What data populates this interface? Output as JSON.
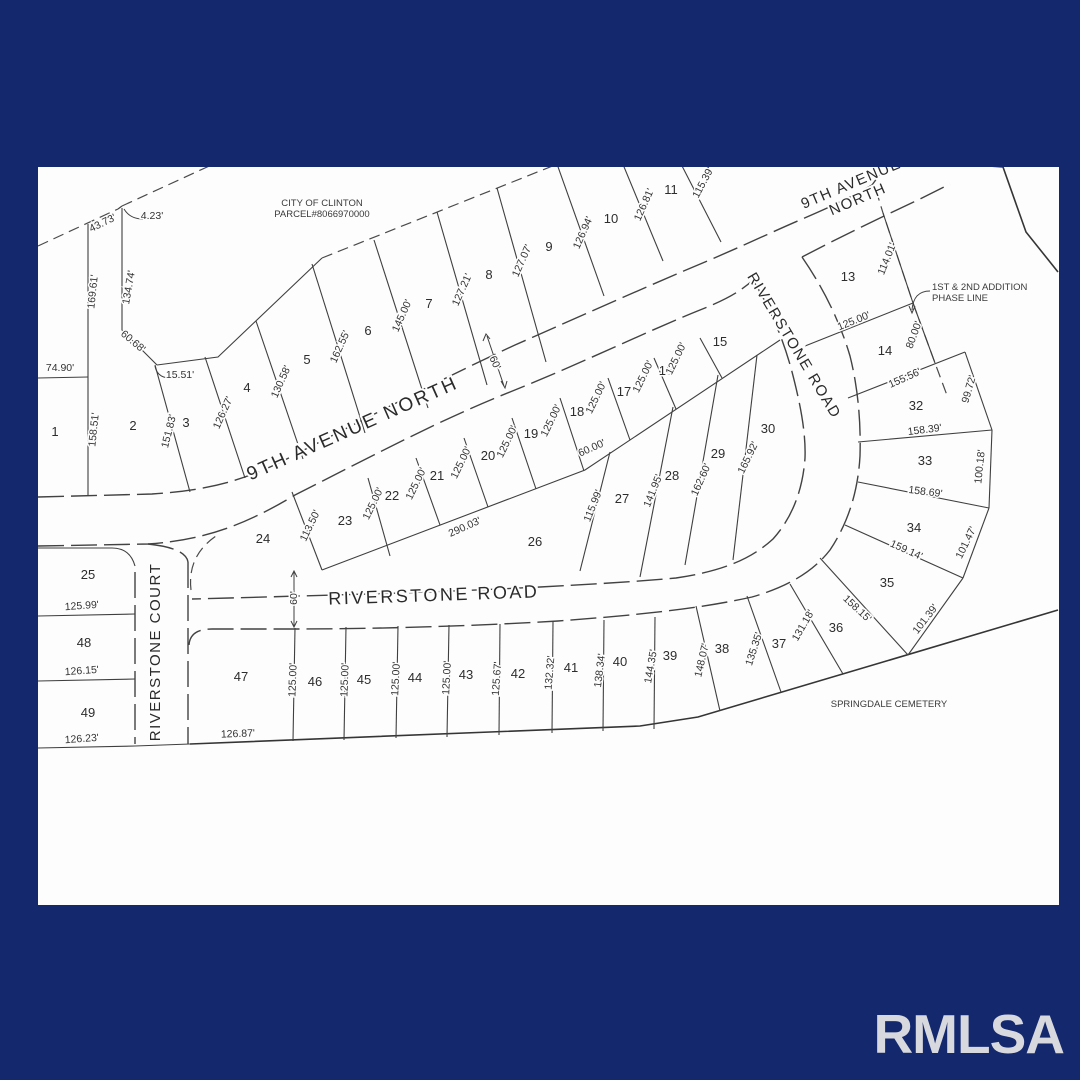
{
  "frame": {
    "navy": "#14286e",
    "paper": "#fdfdfd",
    "watermark": "RMLSA"
  },
  "streets": [
    {
      "name": "street-label-9th-avenue-north-main",
      "lines": [
        "9TH AVENUE NORTH"
      ],
      "x": 355,
      "y": 434,
      "r": -24,
      "size": 19,
      "ls": 2.5
    },
    {
      "name": "street-label-9th-avenue-north-top",
      "lines": [
        "9TH AVENUE",
        "NORTH"
      ],
      "x": 853,
      "y": 188,
      "r": -23,
      "size": 15,
      "ls": 1.5
    },
    {
      "name": "street-label-riverstone-road-upper",
      "lines": [
        "RIVERSTONE ROAD"
      ],
      "x": 790,
      "y": 348,
      "r": 59,
      "size": 15,
      "ls": 1.5
    },
    {
      "name": "street-label-riverstone-road-lower",
      "lines": [
        "RIVERSTONE ROAD"
      ],
      "x": 434,
      "y": 601,
      "r": -2,
      "size": 18,
      "ls": 2.5
    },
    {
      "name": "street-label-riverstone-court",
      "lines": [
        "RIVERSTONE COURT"
      ],
      "x": 160,
      "y": 652,
      "r": -90,
      "size": 15,
      "ls": 1.5
    }
  ],
  "notes": [
    {
      "name": "note-city-parcel",
      "lines": [
        "CITY OF CLINTON",
        "PARCEL#8066970000"
      ],
      "x": 322,
      "y": 206,
      "anchor": "middle"
    },
    {
      "name": "note-phase-line",
      "lines": [
        "1ST & 2ND ADDITION",
        "PHASE LINE"
      ],
      "x": 932,
      "y": 290,
      "anchor": "start"
    },
    {
      "name": "note-springdale-cemetery",
      "lines": [
        "SPRINGDALE CEMETERY"
      ],
      "x": 889,
      "y": 707,
      "anchor": "middle"
    }
  ],
  "lots": [
    {
      "n": "1",
      "x": 55,
      "y": 436
    },
    {
      "n": "2",
      "x": 133,
      "y": 430
    },
    {
      "n": "3",
      "x": 186,
      "y": 427
    },
    {
      "n": "4",
      "x": 247,
      "y": 392
    },
    {
      "n": "5",
      "x": 307,
      "y": 364
    },
    {
      "n": "6",
      "x": 368,
      "y": 335
    },
    {
      "n": "7",
      "x": 429,
      "y": 308
    },
    {
      "n": "8",
      "x": 489,
      "y": 279
    },
    {
      "n": "9",
      "x": 549,
      "y": 251
    },
    {
      "n": "10",
      "x": 611,
      "y": 223
    },
    {
      "n": "11",
      "x": 671,
      "y": 194
    },
    {
      "n": "13",
      "x": 848,
      "y": 281
    },
    {
      "n": "14",
      "x": 885,
      "y": 355
    },
    {
      "n": "15",
      "x": 720,
      "y": 346
    },
    {
      "n": "16",
      "x": 666,
      "y": 375
    },
    {
      "n": "17",
      "x": 624,
      "y": 396
    },
    {
      "n": "18",
      "x": 577,
      "y": 416
    },
    {
      "n": "19",
      "x": 531,
      "y": 438
    },
    {
      "n": "20",
      "x": 488,
      "y": 460
    },
    {
      "n": "21",
      "x": 437,
      "y": 480
    },
    {
      "n": "22",
      "x": 392,
      "y": 500
    },
    {
      "n": "23",
      "x": 345,
      "y": 525
    },
    {
      "n": "24",
      "x": 263,
      "y": 543
    },
    {
      "n": "25",
      "x": 88,
      "y": 579
    },
    {
      "n": "26",
      "x": 535,
      "y": 546
    },
    {
      "n": "27",
      "x": 622,
      "y": 503
    },
    {
      "n": "28",
      "x": 672,
      "y": 480
    },
    {
      "n": "29",
      "x": 718,
      "y": 458
    },
    {
      "n": "30",
      "x": 768,
      "y": 433
    },
    {
      "n": "32",
      "x": 916,
      "y": 410
    },
    {
      "n": "33",
      "x": 925,
      "y": 465
    },
    {
      "n": "34",
      "x": 914,
      "y": 532
    },
    {
      "n": "35",
      "x": 887,
      "y": 587
    },
    {
      "n": "36",
      "x": 836,
      "y": 632
    },
    {
      "n": "37",
      "x": 779,
      "y": 648
    },
    {
      "n": "38",
      "x": 722,
      "y": 653
    },
    {
      "n": "39",
      "x": 670,
      "y": 660
    },
    {
      "n": "40",
      "x": 620,
      "y": 666
    },
    {
      "n": "41",
      "x": 571,
      "y": 672
    },
    {
      "n": "42",
      "x": 518,
      "y": 678
    },
    {
      "n": "43",
      "x": 466,
      "y": 679
    },
    {
      "n": "44",
      "x": 415,
      "y": 682
    },
    {
      "n": "45",
      "x": 364,
      "y": 684
    },
    {
      "n": "46",
      "x": 315,
      "y": 686
    },
    {
      "n": "47",
      "x": 241,
      "y": 681
    },
    {
      "n": "48",
      "x": 84,
      "y": 647
    },
    {
      "n": "49",
      "x": 88,
      "y": 717
    }
  ],
  "dims": [
    {
      "t": "43.73'",
      "x": 104,
      "y": 226,
      "r": -26
    },
    {
      "t": "4.23'",
      "x": 152,
      "y": 219,
      "r": 0
    },
    {
      "t": "134.74'",
      "x": 132,
      "y": 288,
      "r": -80
    },
    {
      "t": "169.61'",
      "x": 96,
      "y": 292,
      "r": -84
    },
    {
      "t": "74.90'",
      "x": 60,
      "y": 371,
      "r": 0
    },
    {
      "t": "60.68'",
      "x": 131,
      "y": 344,
      "r": 40
    },
    {
      "t": "15.51'",
      "x": 180,
      "y": 378,
      "r": 0
    },
    {
      "t": "158.51'",
      "x": 97,
      "y": 430,
      "r": -84
    },
    {
      "t": "151.83'",
      "x": 172,
      "y": 432,
      "r": -76
    },
    {
      "t": "126.27'",
      "x": 226,
      "y": 414,
      "r": -66
    },
    {
      "t": "130.58'",
      "x": 284,
      "y": 383,
      "r": -66
    },
    {
      "t": "162.55'",
      "x": 343,
      "y": 348,
      "r": -66
    },
    {
      "t": "145.00'",
      "x": 405,
      "y": 317,
      "r": -66
    },
    {
      "t": "127.21'",
      "x": 465,
      "y": 291,
      "r": -66
    },
    {
      "t": "127.07'",
      "x": 525,
      "y": 262,
      "r": -66
    },
    {
      "t": "126.94'",
      "x": 586,
      "y": 234,
      "r": -66
    },
    {
      "t": "126.81'",
      "x": 647,
      "y": 206,
      "r": -66
    },
    {
      "t": "115.39'",
      "x": 706,
      "y": 184,
      "r": -62
    },
    {
      "t": "114.01'",
      "x": 890,
      "y": 260,
      "r": -68
    },
    {
      "t": "125.00'",
      "x": 855,
      "y": 324,
      "r": -22
    },
    {
      "t": "80.00'",
      "x": 917,
      "y": 336,
      "r": -70
    },
    {
      "t": "155.56'",
      "x": 906,
      "y": 381,
      "r": -24
    },
    {
      "t": "99.72'",
      "x": 972,
      "y": 390,
      "r": -74
    },
    {
      "t": "158.39'",
      "x": 925,
      "y": 433,
      "r": -7
    },
    {
      "t": "100.18'",
      "x": 983,
      "y": 467,
      "r": -84
    },
    {
      "t": "158.69'",
      "x": 925,
      "y": 495,
      "r": 7
    },
    {
      "t": "101.47'",
      "x": 969,
      "y": 544,
      "r": -64
    },
    {
      "t": "159.14'",
      "x": 905,
      "y": 553,
      "r": 24
    },
    {
      "t": "158.15'",
      "x": 855,
      "y": 611,
      "r": 43
    },
    {
      "t": "101.39'",
      "x": 928,
      "y": 621,
      "r": -52
    },
    {
      "t": "131.18'",
      "x": 806,
      "y": 627,
      "r": -60
    },
    {
      "t": "135.35'",
      "x": 757,
      "y": 650,
      "r": -72
    },
    {
      "t": "148.07'",
      "x": 705,
      "y": 661,
      "r": -77
    },
    {
      "t": "144.35'",
      "x": 654,
      "y": 667,
      "r": -80
    },
    {
      "t": "138.34'",
      "x": 603,
      "y": 671,
      "r": -83
    },
    {
      "t": "132.32'",
      "x": 553,
      "y": 673,
      "r": -85
    },
    {
      "t": "125.67'",
      "x": 500,
      "y": 679,
      "r": -86
    },
    {
      "t": "125.00'",
      "x": 450,
      "y": 678,
      "r": -87
    },
    {
      "t": "125.00'",
      "x": 399,
      "y": 679,
      "r": -87
    },
    {
      "t": "125.00'",
      "x": 348,
      "y": 680,
      "r": -88
    },
    {
      "t": "125.00'",
      "x": 296,
      "y": 680,
      "r": -88
    },
    {
      "t": "126.87'",
      "x": 238,
      "y": 737,
      "r": -2
    },
    {
      "t": "126.23'",
      "x": 82,
      "y": 742,
      "r": -4
    },
    {
      "t": "126.15'",
      "x": 82,
      "y": 674,
      "r": -4
    },
    {
      "t": "125.99'",
      "x": 82,
      "y": 609,
      "r": -4
    },
    {
      "t": "113.50'",
      "x": 313,
      "y": 527,
      "r": -64
    },
    {
      "t": "290.03'",
      "x": 466,
      "y": 530,
      "r": -24
    },
    {
      "t": "125.00'",
      "x": 376,
      "y": 505,
      "r": -64
    },
    {
      "t": "125.00'",
      "x": 419,
      "y": 485,
      "r": -64
    },
    {
      "t": "125.00'",
      "x": 464,
      "y": 464,
      "r": -64
    },
    {
      "t": "125.00'",
      "x": 510,
      "y": 443,
      "r": -64
    },
    {
      "t": "125.00'",
      "x": 554,
      "y": 422,
      "r": -64
    },
    {
      "t": "125.00'",
      "x": 599,
      "y": 399,
      "r": -64
    },
    {
      "t": "125.00'",
      "x": 646,
      "y": 378,
      "r": -64
    },
    {
      "t": "125.00'",
      "x": 679,
      "y": 360,
      "r": -64
    },
    {
      "t": "60.00'",
      "x": 593,
      "y": 451,
      "r": -24
    },
    {
      "t": "115.99'",
      "x": 596,
      "y": 507,
      "r": -68
    },
    {
      "t": "141.95'",
      "x": 656,
      "y": 492,
      "r": -68
    },
    {
      "t": "162.60'",
      "x": 704,
      "y": 481,
      "r": -66
    },
    {
      "t": "165.92'",
      "x": 751,
      "y": 459,
      "r": -64
    },
    {
      "t": "60'",
      "x": 297,
      "y": 598,
      "r": -90
    },
    {
      "t": "60'",
      "x": 492,
      "y": 364,
      "r": 66
    }
  ]
}
